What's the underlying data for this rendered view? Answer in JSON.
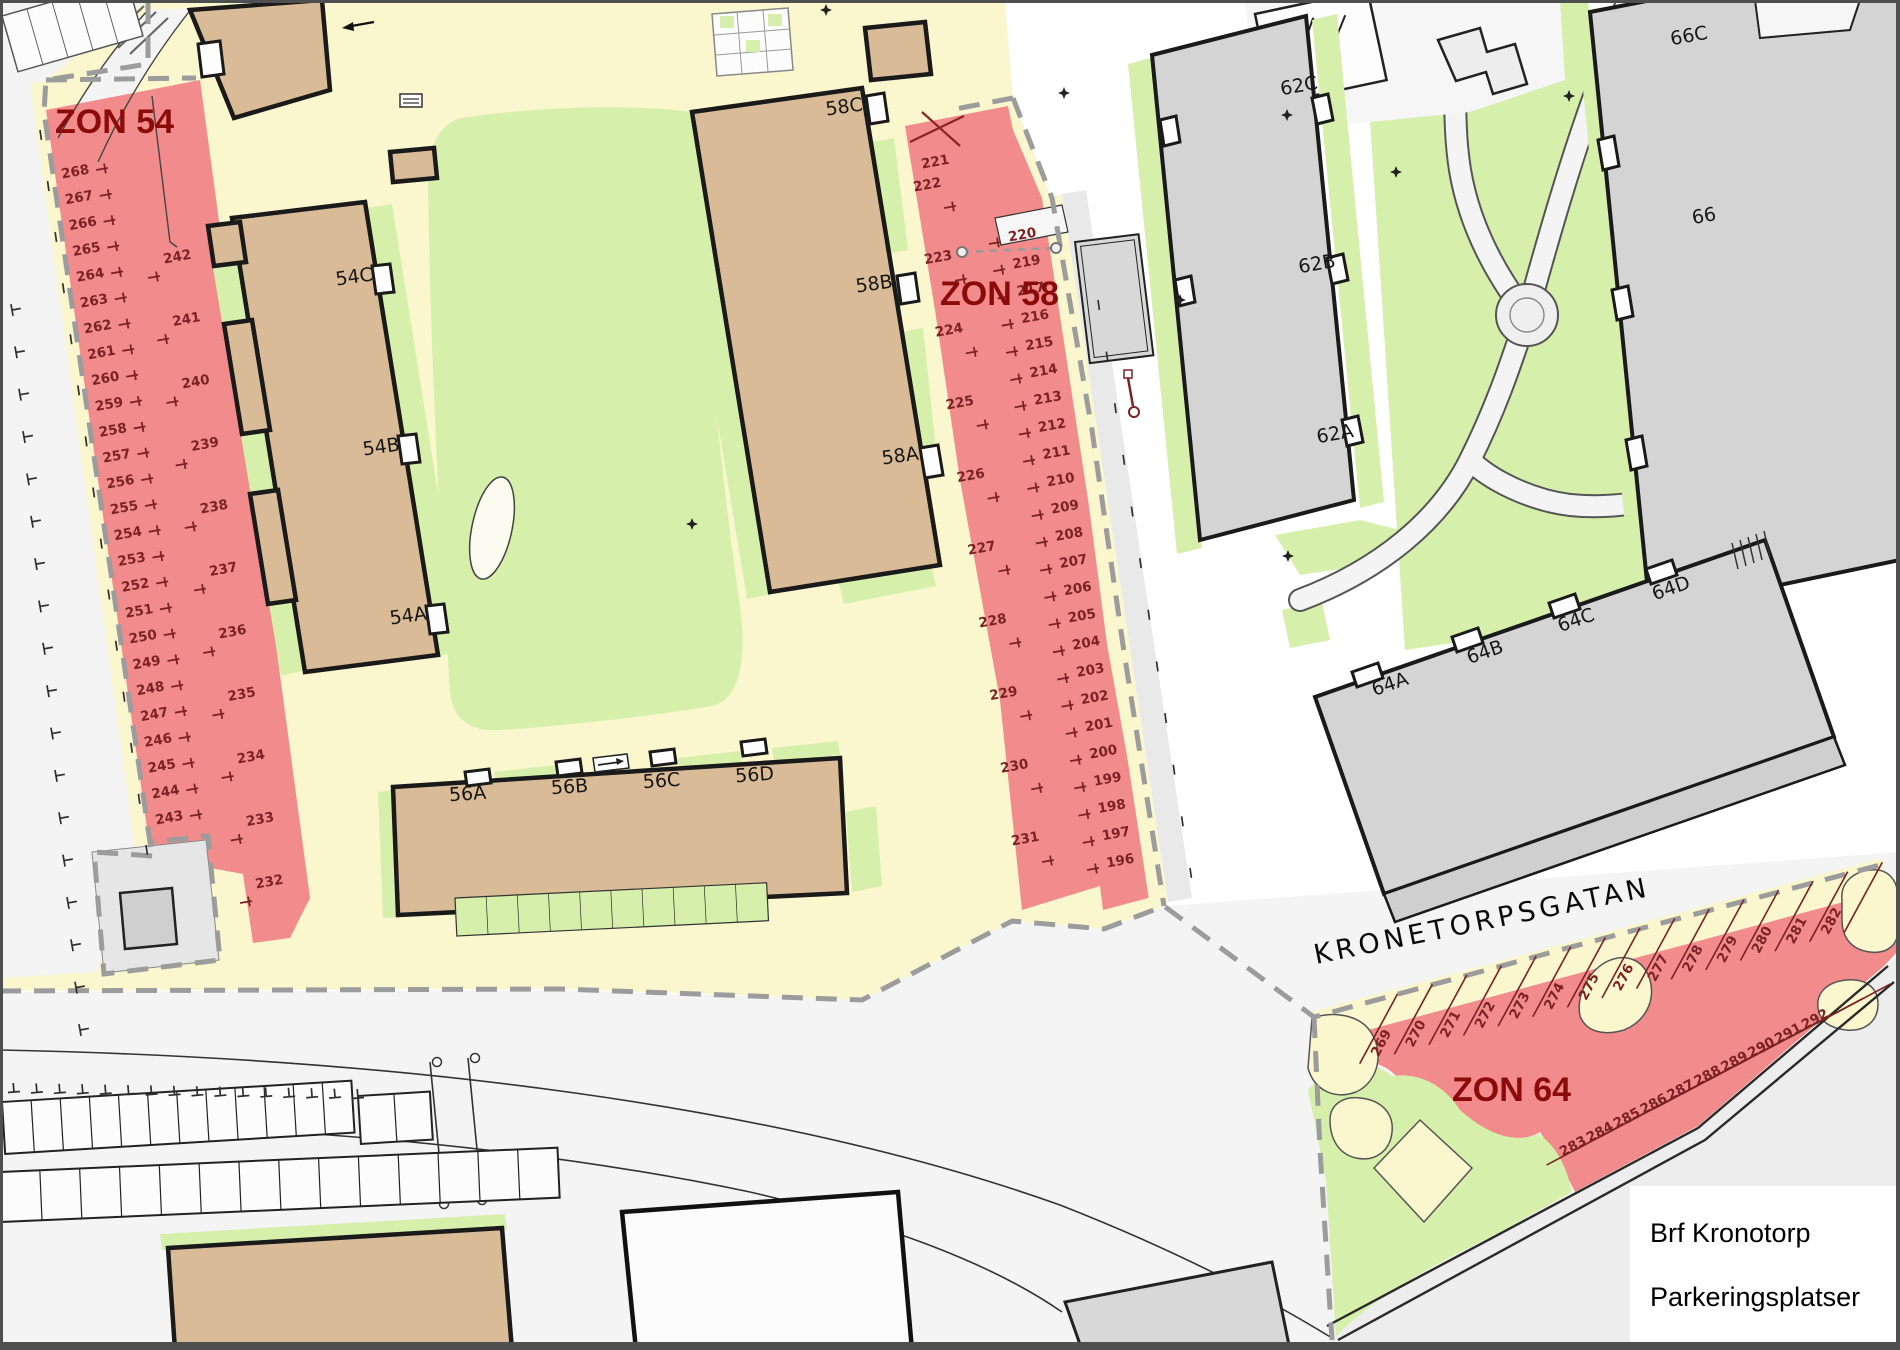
{
  "legend": {
    "line1": "Brf Kronotorp",
    "line2": "Parkeringsplatser"
  },
  "street": {
    "name": "KRONETORPSGATAN"
  },
  "zones": [
    {
      "id": "54",
      "label": "ZON 54",
      "columns": [
        {
          "numbers": [
            "268",
            "267",
            "266",
            "265",
            "264",
            "263",
            "262",
            "261",
            "260",
            "259",
            "258",
            "257",
            "256",
            "255",
            "254",
            "253",
            "252",
            "251",
            "250",
            "249",
            "248",
            "247",
            "246",
            "245",
            "244",
            "243"
          ]
        },
        {
          "numbers": [
            "242",
            "241",
            "240",
            "239",
            "238",
            "237",
            "236",
            "235",
            "234",
            "233",
            "232"
          ]
        }
      ]
    },
    {
      "id": "58",
      "label": "ZON 58",
      "crossed_out": "221",
      "columns": [
        {
          "numbers": [
            "222",
            "223",
            "224",
            "225",
            "226",
            "227",
            "228",
            "229",
            "230",
            "231"
          ]
        },
        {
          "numbers": [
            "220",
            "219",
            "217",
            "216",
            "215",
            "214",
            "213",
            "212",
            "211",
            "210",
            "209",
            "208",
            "207",
            "206",
            "205",
            "204",
            "203",
            "202",
            "201",
            "200",
            "199",
            "198",
            "197",
            "196"
          ]
        }
      ]
    },
    {
      "id": "64",
      "label": "ZON 64",
      "rows": [
        {
          "numbers": [
            "269",
            "270",
            "271",
            "272",
            "273",
            "274",
            "275",
            "276",
            "277",
            "278",
            "279",
            "280",
            "281",
            "282"
          ]
        },
        {
          "numbers": [
            "283",
            "284",
            "285",
            "286",
            "287",
            "288",
            "289",
            "290",
            "291",
            "292"
          ]
        }
      ]
    }
  ],
  "buildings": {
    "b54": {
      "sections": [
        "54C",
        "54B",
        "54A"
      ]
    },
    "b56": {
      "sections": [
        "56A",
        "56B",
        "56C",
        "56D"
      ]
    },
    "b58": {
      "sections": [
        "58C",
        "58B",
        "58A"
      ]
    },
    "b62": {
      "sections": [
        "62C",
        "62B",
        "62A"
      ]
    },
    "b64": {
      "sections": [
        "64A",
        "64B",
        "64C",
        "64D"
      ]
    },
    "b66": {
      "sections": [
        "66C",
        "66"
      ]
    }
  },
  "colors": {
    "zone_fill": "#F28B8B",
    "zone_label": "#8B0B0B",
    "spot_number": "#7B2222",
    "building_tan": "#D9BC97",
    "building_gray": "#D4D4D4",
    "green": "#D6F0AC",
    "yellow": "#FAF6CE",
    "street": "#F4F4F4",
    "boundary_dash": "#9C9C9C",
    "ink": "#1A1A1A"
  }
}
